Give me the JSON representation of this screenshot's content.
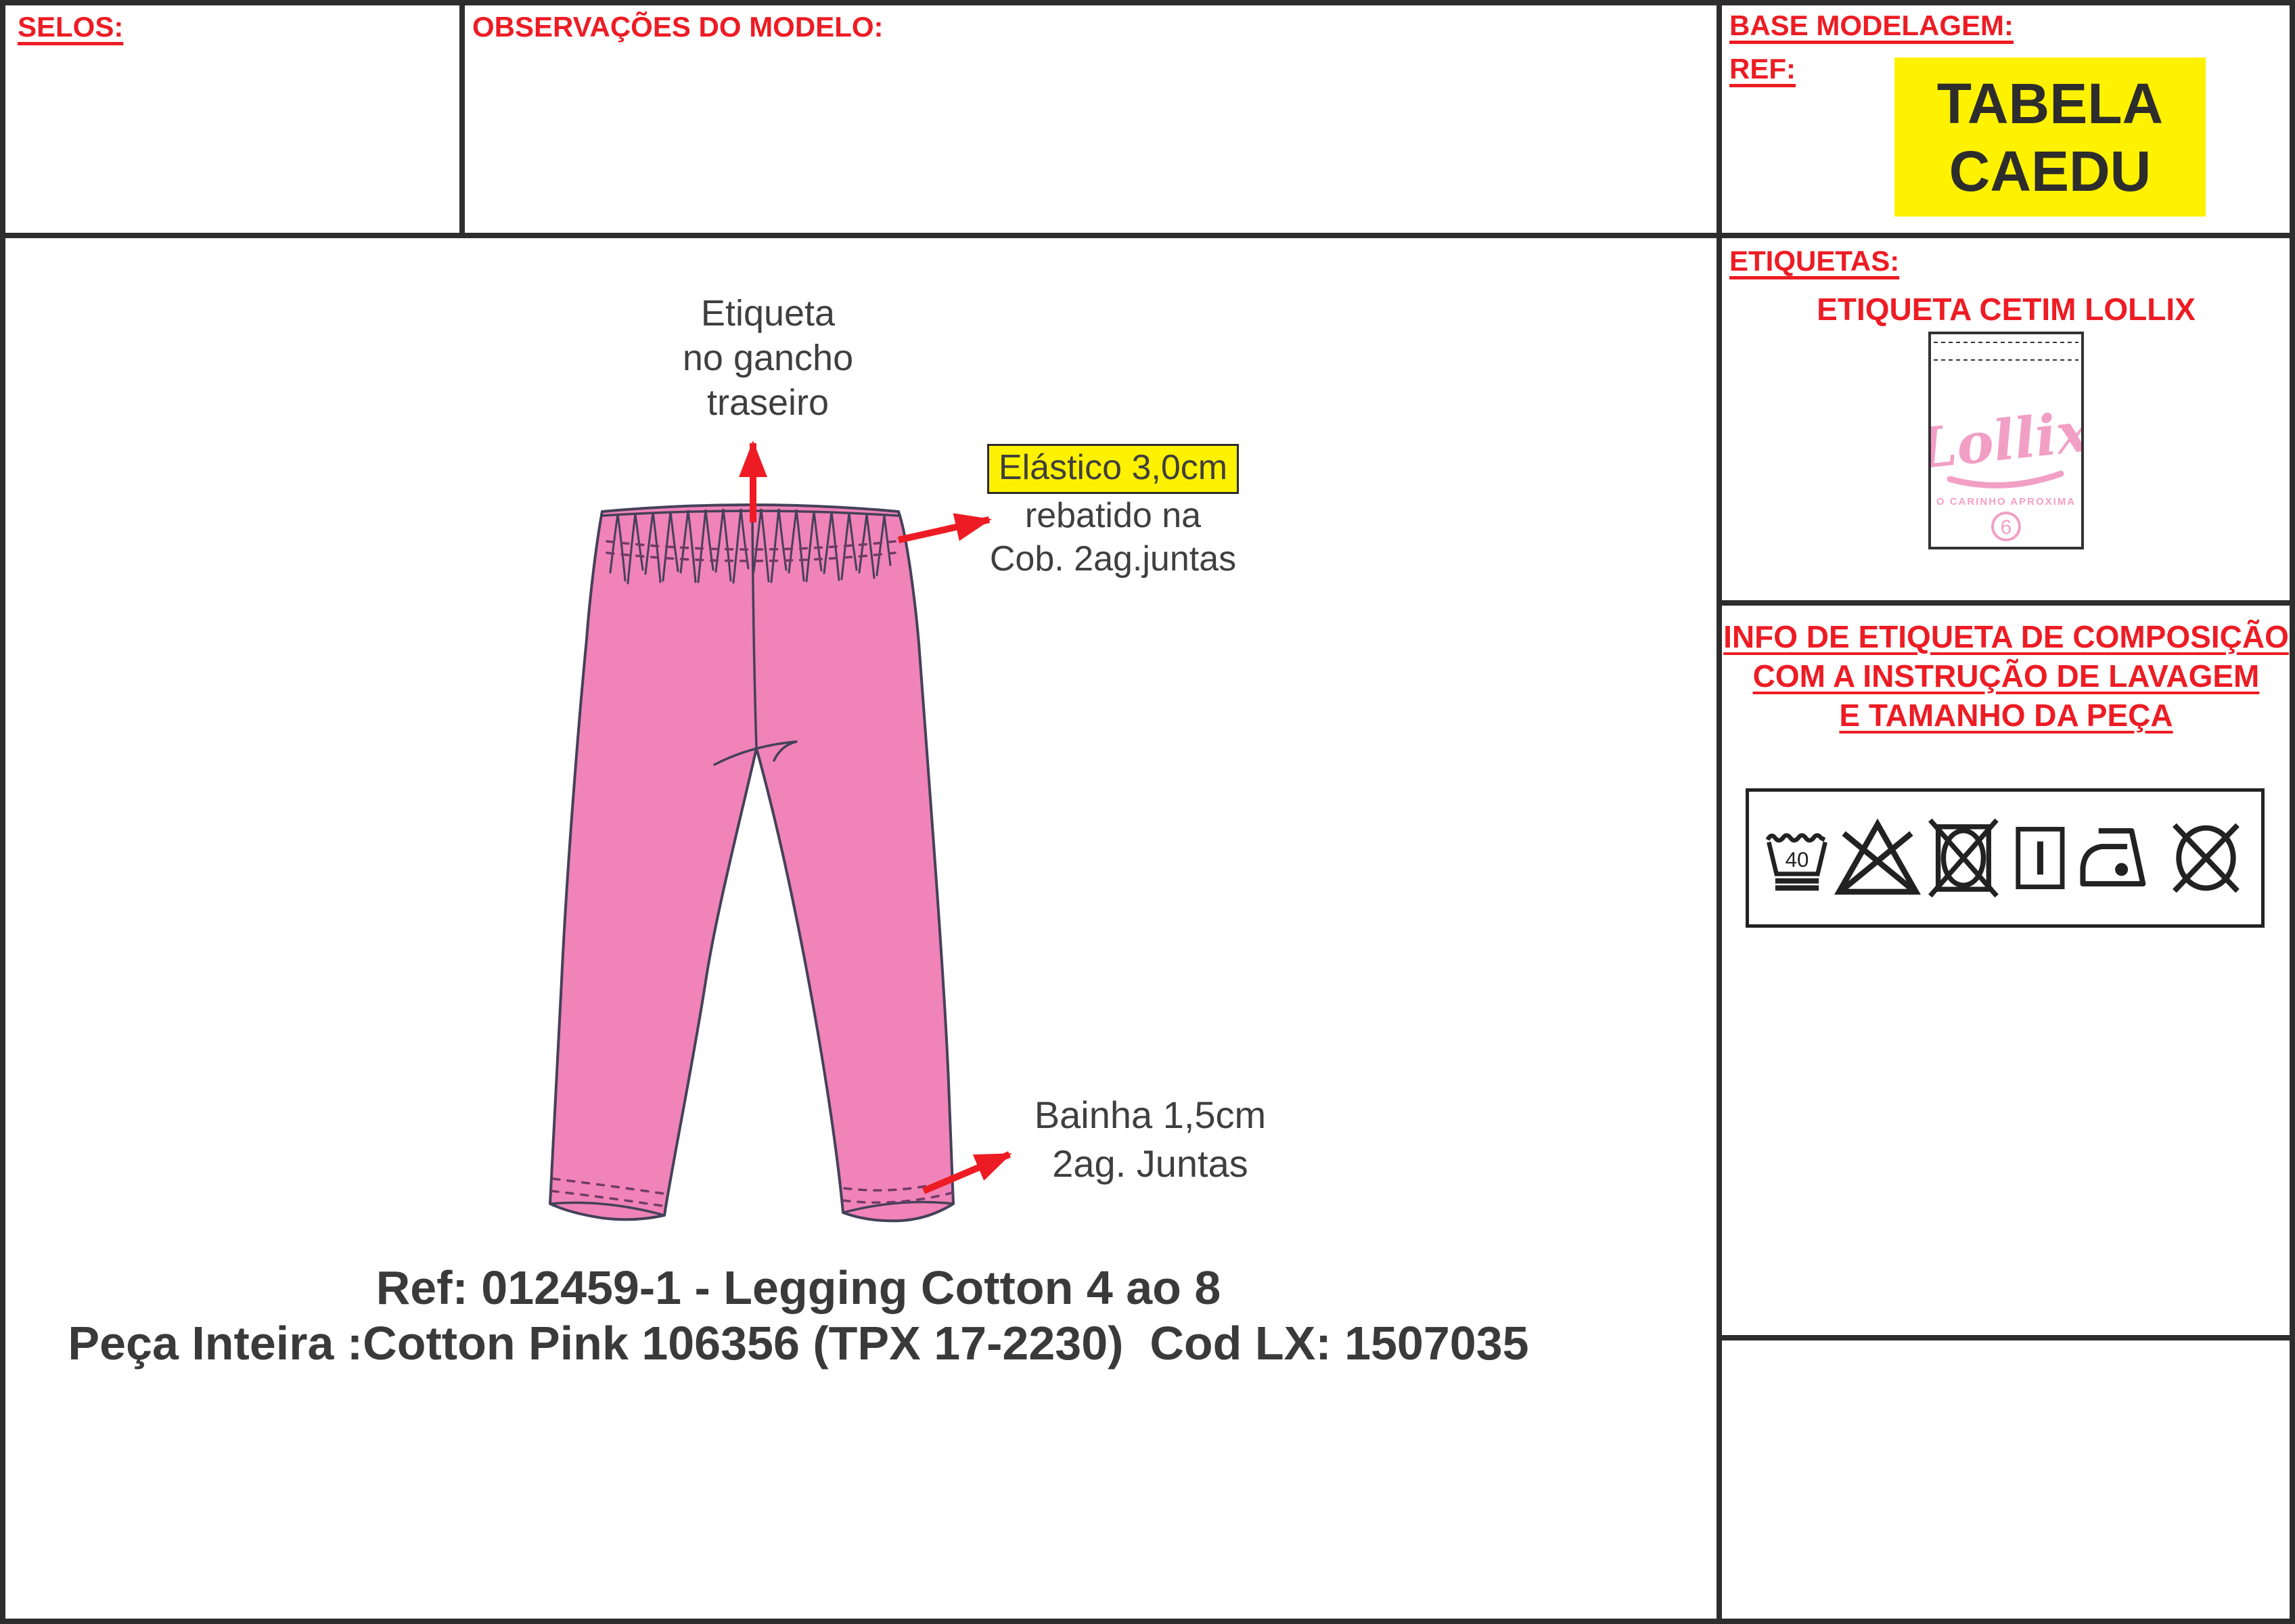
{
  "header": {
    "selos_label": "SELOS:",
    "observacoes_label": "OBSERVAÇÕES DO MODELO:",
    "base_modelagem_label": "BASE MODELAGEM:",
    "ref_label": "REF:",
    "tabela_line1": "TABELA",
    "tabela_line2": "CAEDU"
  },
  "etiquetas": {
    "section_label": "ETIQUETAS:",
    "subtitle": "ETIQUETA CETIM LOLLIX",
    "label_logo": "Lollix",
    "label_tagline": "O CARINHO APROXIMA",
    "label_size": "6"
  },
  "composicao": {
    "line1": "INFO DE ETIQUETA DE COMPOSIÇÃO",
    "line2": "COM A INSTRUÇÃO DE LAVAGEM",
    "line3": "E TAMANHO DA PEÇA",
    "wash_temp": "40",
    "care_symbols": [
      "wash-40-very-mild",
      "do-not-bleach",
      "do-not-tumble-dry",
      "line-dry",
      "iron-low",
      "do-not-dry-clean"
    ]
  },
  "sketch": {
    "note_waist_tag_line1": "Etiqueta",
    "note_waist_tag_line2": "no gancho",
    "note_waist_tag_line3": "traseiro",
    "note_elastic_highlight": "Elástico 3,0cm",
    "note_elastic_line2": "rebatido na",
    "note_elastic_line3": "Cob. 2ag.juntas",
    "note_hem_line1": "Bainha 1,5cm",
    "note_hem_line2": "2ag. Juntas"
  },
  "footer": {
    "line1": "Ref: 012459-1 - Legging Cotton 4 ao 8",
    "line2": "Peça Inteira :Cotton Pink 106356 (TPX 17-2230)  Cod LX: 1507035"
  },
  "colors": {
    "accent_red": "#ED1C24",
    "highlight_yellow": "#FFF200",
    "garment_pink": "#F083B8",
    "label_pink": "#F29FC5",
    "text_dark": "#3F3F3F"
  }
}
